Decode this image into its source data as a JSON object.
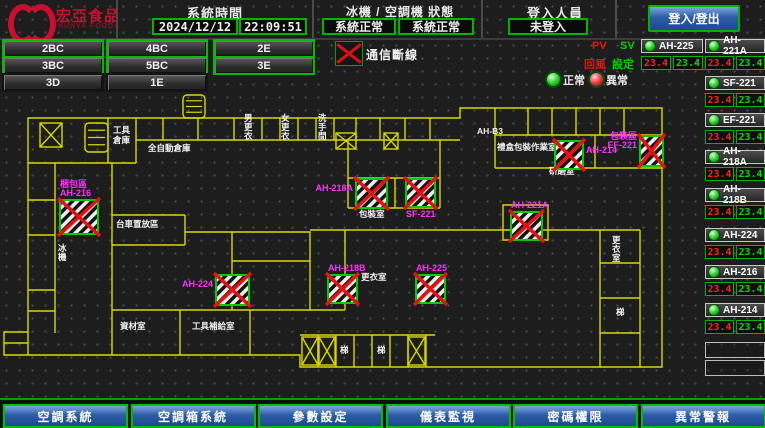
{
  "header": {
    "logo": {
      "line1": "宏亞食品",
      "line2": "HUNYA FOODS"
    },
    "system_time": {
      "label": "系統時間",
      "date": "2024/12/12",
      "time": "22:09:51"
    },
    "machine_status": {
      "label": "冰機 / 空調機 狀態",
      "chiller": "系統正常",
      "ahu": "系統正常"
    },
    "login": {
      "label": "登入人員",
      "value": "未登入",
      "button": "登入/登出"
    }
  },
  "floor_buttons": [
    {
      "label": "2BC",
      "green": true,
      "x": 2,
      "y": 39
    },
    {
      "label": "4BC",
      "green": true,
      "x": 106,
      "y": 39
    },
    {
      "label": "2E",
      "green": true,
      "x": 213,
      "y": 39
    },
    {
      "label": "3BC",
      "green": true,
      "x": 2,
      "y": 56
    },
    {
      "label": "5BC",
      "green": true,
      "x": 106,
      "y": 56
    },
    {
      "label": "3E",
      "green": true,
      "x": 213,
      "y": 56
    },
    {
      "label": "3D",
      "green": false,
      "x": 2,
      "y": 73
    },
    {
      "label": "1E",
      "green": false,
      "x": 106,
      "y": 73
    }
  ],
  "legend": {
    "comm_loss": "通信斷線",
    "normal": "正常",
    "abnormal": "異常",
    "pv": "PV",
    "sv": "SV",
    "pv_desc": "回風",
    "sv_desc": "設定"
  },
  "units": {
    "featured": {
      "name": "AH-225",
      "pv": "23.4",
      "sv": "23.4"
    },
    "list": [
      {
        "name": "AH-221A",
        "pv": "23.4",
        "sv": "23.4"
      },
      {
        "name": "SF-221",
        "pv": "23.4",
        "sv": "23.4"
      },
      {
        "name": "EF-221",
        "pv": "23.4",
        "sv": "23.4"
      },
      {
        "name": "AH-218A",
        "pv": "23.4",
        "sv": "23.4"
      },
      {
        "name": "AH-218B",
        "pv": "23.4",
        "sv": "23.4"
      },
      {
        "name": "AH-224",
        "pv": "23.4",
        "sv": "23.4"
      },
      {
        "name": "AH-216",
        "pv": "23.4",
        "sv": "23.4"
      },
      {
        "name": "AH-214",
        "pv": "23.4",
        "sv": "23.4"
      }
    ],
    "empty_slots": 2
  },
  "plan": {
    "walls": [
      "M28,262 L28,25 L460,25 L460,15 L662,15 L662,274 L300,274 L300,262 L28,262",
      "M28,239 L4,239 L4,262 L28,262 M4,250 L28,250",
      "M136,47 L460,47",
      "M163,25 V47 M198,25 V47 M234,25 V47 M262,25 V47 M280,25 V47 M298,25 V47 M316,25 V47 M334,25 V47 M356,25 V47 M380,25 V47 M405,25 V47 M430,25 V47",
      "M28,70 H136 M136,25 V70 M108,25 V70",
      "M55,70 V240 M28,107 H55 M28,142 H55 M28,197 H55 M28,218 H55",
      "M112,70 V262 M112,122 H185 M185,122 V152 M112,152 H185 M112,217 H185",
      "M185,139 H310 V217 H185 M232,139 V217 M232,168 H310",
      "M345,137 V217 M310,217 H345",
      "M310,137 H640",
      "M348,47 V115 M440,47 V115 M348,85 H440 M395,85 V115 M348,115 H440",
      "M495,15 V75 M495,75 H662 M495,42 H662 M528,15 V42 M552,15 V42 M576,15 V42 M600,15 V42 M624,15 V42 M595,42 V75",
      "M503,112 H548 V147 H503 Z",
      "M600,137 V274 M640,137 V274 M600,170 H640 M600,205 H640 M600,240 H640",
      "M300,242 H435 M318,242 V274 M336,242 V274 M354,242 V274 M372,242 V274 M390,242 V274 M408,242 V274 M426,242 V274",
      "M180,217 V262 M250,217 V262"
    ],
    "devices": [
      {
        "x": 60,
        "y": 107,
        "w": 38,
        "h": 34,
        "label": [
          "梱包區",
          "AH-216"
        ],
        "lpos": "above"
      },
      {
        "x": 216,
        "y": 182,
        "w": 33,
        "h": 30,
        "label": [
          "AH-224"
        ],
        "lpos": "left"
      },
      {
        "x": 328,
        "y": 182,
        "w": 29,
        "h": 28,
        "label": [
          "AH-218B"
        ],
        "lpos": "above"
      },
      {
        "x": 356,
        "y": 86,
        "w": 31,
        "h": 29,
        "label": [
          "AH-218A"
        ],
        "lpos": "left"
      },
      {
        "x": 406,
        "y": 86,
        "w": 29,
        "h": 28,
        "label": [
          "SF-221"
        ],
        "lpos": "below"
      },
      {
        "x": 416,
        "y": 182,
        "w": 29,
        "h": 28,
        "label": [
          "AH-225"
        ],
        "lpos": "above"
      },
      {
        "x": 511,
        "y": 119,
        "w": 31,
        "h": 28,
        "label": [
          "AH-221A"
        ],
        "lpos": "above"
      },
      {
        "x": 555,
        "y": 48,
        "w": 28,
        "h": 28,
        "label": [
          "AH-214"
        ],
        "lpos": "right"
      },
      {
        "x": 640,
        "y": 43,
        "w": 23,
        "h": 30,
        "label": [
          "包裝區",
          "EF-221"
        ],
        "lpos": "left"
      }
    ],
    "shafts": [
      {
        "x": 40,
        "y": 30,
        "w": 22,
        "h": 24
      },
      {
        "x": 336,
        "y": 40,
        "w": 20,
        "h": 16
      },
      {
        "x": 384,
        "y": 40,
        "w": 14,
        "h": 16
      },
      {
        "x": 302,
        "y": 244,
        "w": 16,
        "h": 28
      },
      {
        "x": 319,
        "y": 244,
        "w": 16,
        "h": 28
      },
      {
        "x": 408,
        "y": 244,
        "w": 17,
        "h": 28
      }
    ],
    "stairs": [
      {
        "x": 85,
        "y": 30,
        "w": 23,
        "h": 29
      },
      {
        "x": 183,
        "y": 2,
        "w": 22,
        "h": 23
      }
    ],
    "rooms": [
      {
        "t": "工具",
        "x": 113,
        "y": 40
      },
      {
        "t": "倉庫",
        "x": 113,
        "y": 50
      },
      {
        "t": "全自動倉庫",
        "x": 148,
        "y": 58
      },
      {
        "t": "男更衣",
        "x": 244,
        "y": 28,
        "v": true
      },
      {
        "t": "女更衣",
        "x": 281,
        "y": 28,
        "v": true
      },
      {
        "t": "洗手間",
        "x": 318,
        "y": 28,
        "v": true
      },
      {
        "t": "台車置放區",
        "x": 116,
        "y": 134
      },
      {
        "t": "AH-B3",
        "x": 477,
        "y": 41
      },
      {
        "t": "禮盒包裝作業室",
        "x": 497,
        "y": 57
      },
      {
        "t": "研磨室",
        "x": 549,
        "y": 81
      },
      {
        "t": "包裝室",
        "x": 359,
        "y": 124
      },
      {
        "t": "更衣室",
        "x": 361,
        "y": 187
      },
      {
        "t": "更衣室",
        "x": 612,
        "y": 150,
        "v": true
      },
      {
        "t": "梯",
        "x": 616,
        "y": 222
      },
      {
        "t": "梯",
        "x": 340,
        "y": 260
      },
      {
        "t": "梯",
        "x": 377,
        "y": 260
      },
      {
        "t": "冰機",
        "x": 58,
        "y": 158,
        "v": true
      },
      {
        "t": "資材室",
        "x": 120,
        "y": 236
      },
      {
        "t": "工具補給室",
        "x": 192,
        "y": 236
      }
    ]
  },
  "footer": {
    "buttons": [
      "空調系統",
      "空調箱系統",
      "參數設定",
      "儀表監視",
      "密碼權限",
      "異常警報"
    ]
  },
  "colors": {
    "accent_green": "#00c400",
    "alarm_red": "#e01010",
    "magenta": "#ff30ff",
    "wall_yellow": "#d8d800",
    "button_blue": "#2d5da8"
  }
}
